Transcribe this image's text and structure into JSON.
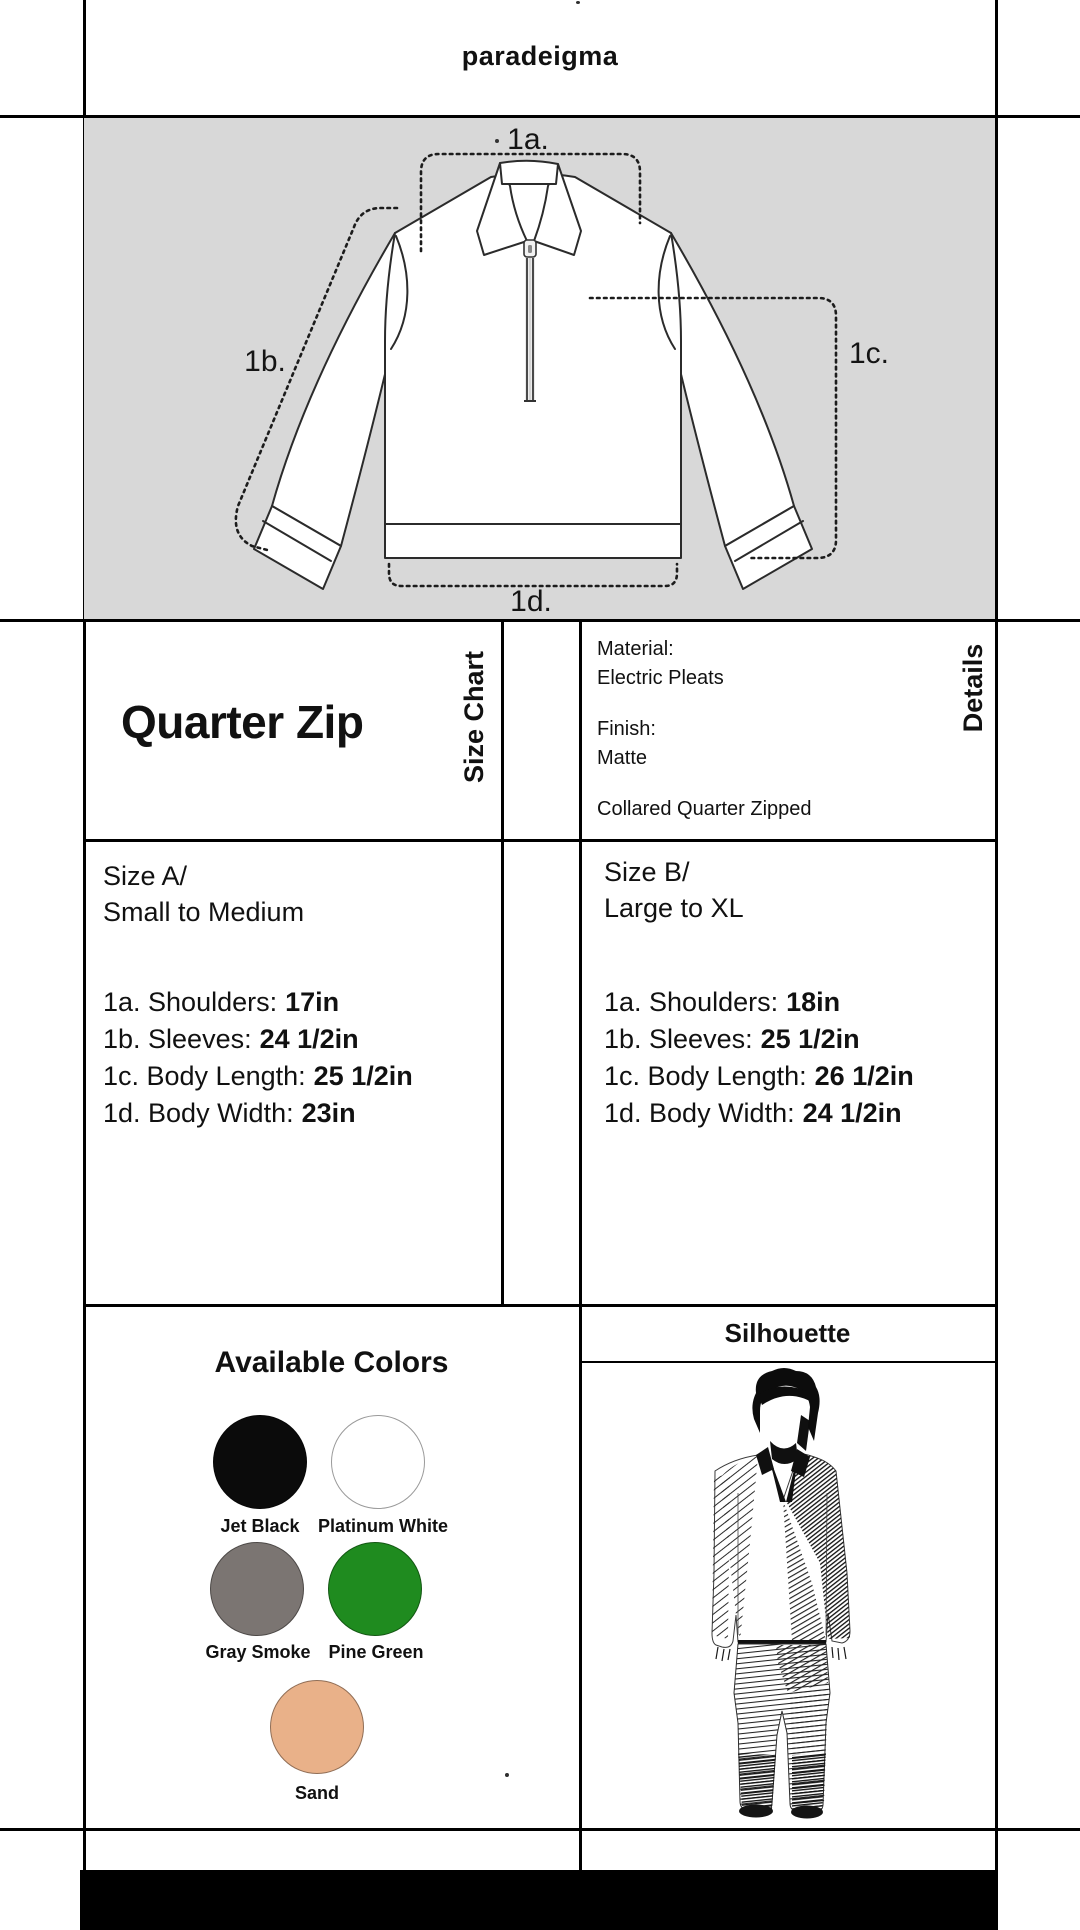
{
  "brand": "paradeigma",
  "product": {
    "title": "Quarter Zip"
  },
  "panel_labels": {
    "size_chart": "Size Chart",
    "details": "Details"
  },
  "diagram": {
    "background": "#d8d8d8",
    "label_a": "1a.",
    "label_b": "1b.",
    "label_c": "1c.",
    "label_d": "1d."
  },
  "details": {
    "material_label": "Material:",
    "material_value": "Electric Pleats",
    "finish_label": "Finish:",
    "finish_value": "Matte",
    "style_note": "Collared Quarter Zipped"
  },
  "sizes": [
    {
      "name": "Size A/",
      "range": "Small to Medium",
      "measurements": [
        {
          "label": "1a. Shoulders:",
          "value": "17in"
        },
        {
          "label": "1b. Sleeves:",
          "value": "24 1/2in"
        },
        {
          "label": "1c. Body Length:",
          "value": "25 1/2in"
        },
        {
          "label": "1d. Body Width:",
          "value": "23in"
        }
      ]
    },
    {
      "name": "Size B/",
      "range": "Large to XL",
      "measurements": [
        {
          "label": "1a. Shoulders:",
          "value": "18in"
        },
        {
          "label": "1b. Sleeves:",
          "value": "25 1/2in"
        },
        {
          "label": "1c. Body Length:",
          "value": "26 1/2in"
        },
        {
          "label": "1d. Body Width:",
          "value": "24 1/2in"
        }
      ]
    }
  ],
  "colors_section": {
    "title": "Available Colors",
    "swatches": [
      {
        "name": "Jet Black",
        "hex": "#0b0b0b"
      },
      {
        "name": "Platinum White",
        "hex": "#ffffff"
      },
      {
        "name": "Gray Smoke",
        "hex": "#7b7572"
      },
      {
        "name": "Pine Green",
        "hex": "#1f8b1f"
      },
      {
        "name": "Sand",
        "hex": "#e9b189"
      }
    ]
  },
  "silhouette_section": {
    "title": "Silhouette"
  }
}
